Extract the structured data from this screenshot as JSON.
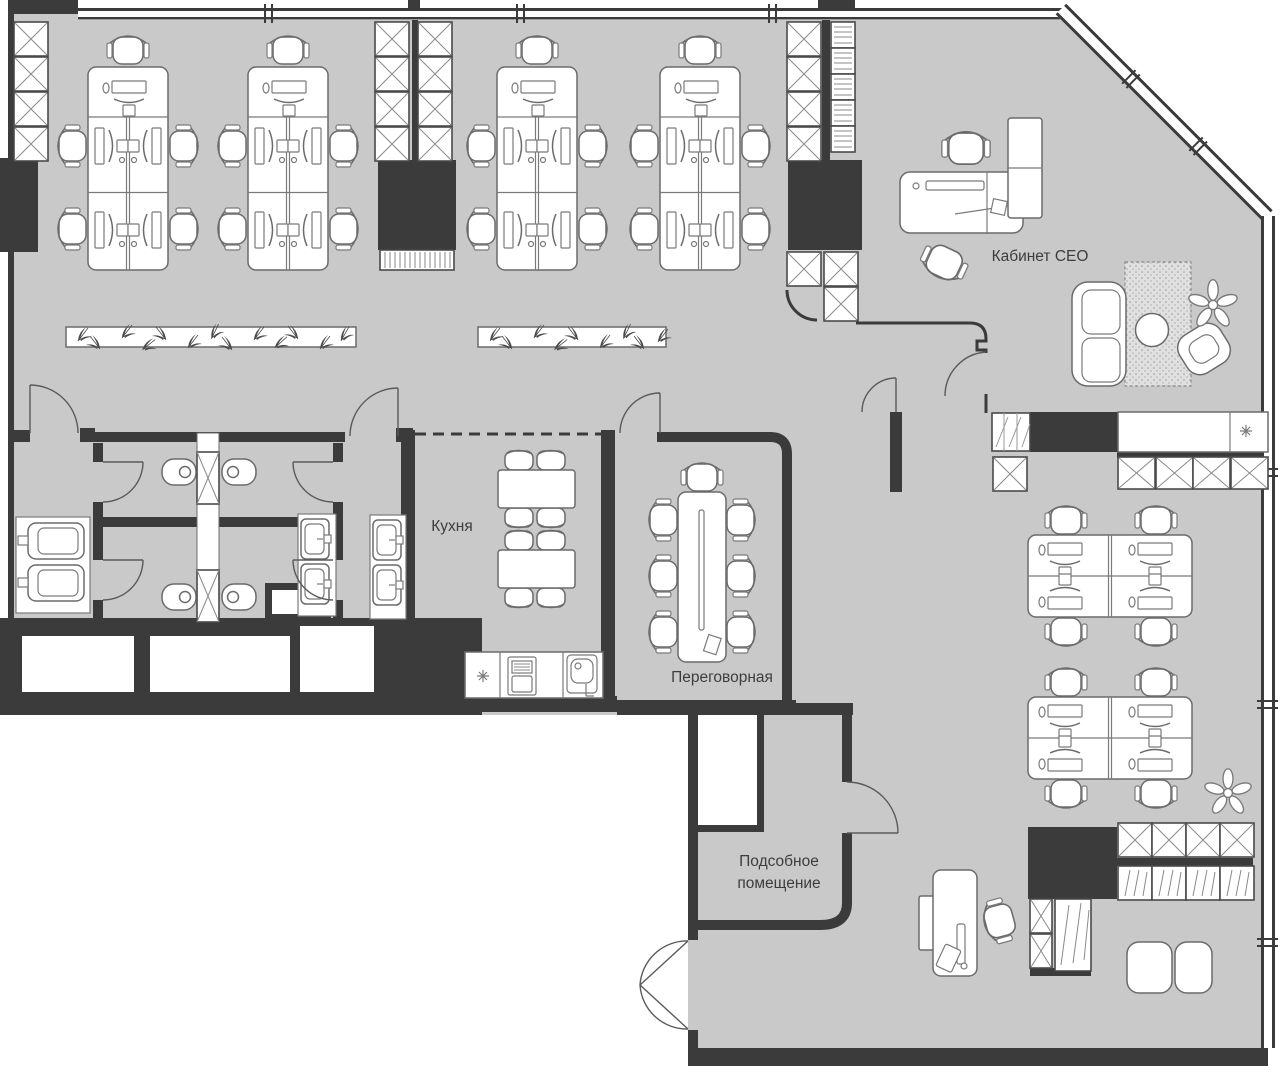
{
  "plan": {
    "colors": {
      "background": "#ffffff",
      "floor": "#c9c9c9",
      "wall": "#3b3b3b",
      "furniture_fill": "#ffffff",
      "furniture_outline": "#6b6b6b",
      "label_text": "#3d3d3d"
    },
    "rooms": {
      "ceo_office": {
        "label": "Кабинет CEO"
      },
      "kitchen": {
        "label": "Кухня"
      },
      "meeting_room": {
        "label": "Переговорная"
      },
      "utility_room": {
        "label_line1": "Подсобное",
        "label_line2": "помещение"
      }
    }
  }
}
